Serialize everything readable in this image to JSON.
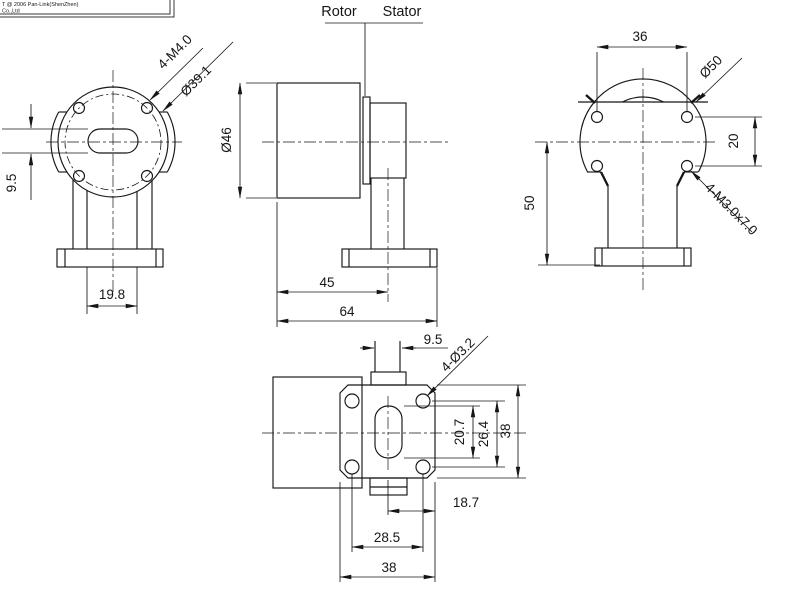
{
  "colors": {
    "line": "#161616",
    "background": "#ffffff"
  },
  "title_block": {
    "line1": "T @ 2006 Pan-Link(ShenZhen)",
    "line2": "Co.,Ltd"
  },
  "part_labels": {
    "rotor": "Rotor",
    "stator": "Stator"
  },
  "front_view": {
    "screw_callout": "4-M4.0",
    "bolt_circle_dia": "Ø39.1",
    "slot_width": "9.5",
    "neck_width": "19.8"
  },
  "side_view": {
    "body_dia": "Ø46",
    "body_length": "45",
    "overall_length": "64"
  },
  "right_view": {
    "hole_span": "36",
    "body_dia": "Ø50",
    "hole_pitch": "20",
    "mount_height": "50",
    "screw_callout": "4-M3.0x7.0"
  },
  "bottom_view": {
    "boss_width": "9.5",
    "hole_callout": "4-Ø3.2",
    "slot_length": "20.7",
    "hole_pitch_vertical": "26.4",
    "plate_depth": "38",
    "center_to_edge": "18.7",
    "hole_pitch_horizontal": "28.5",
    "plate_width": "38"
  }
}
